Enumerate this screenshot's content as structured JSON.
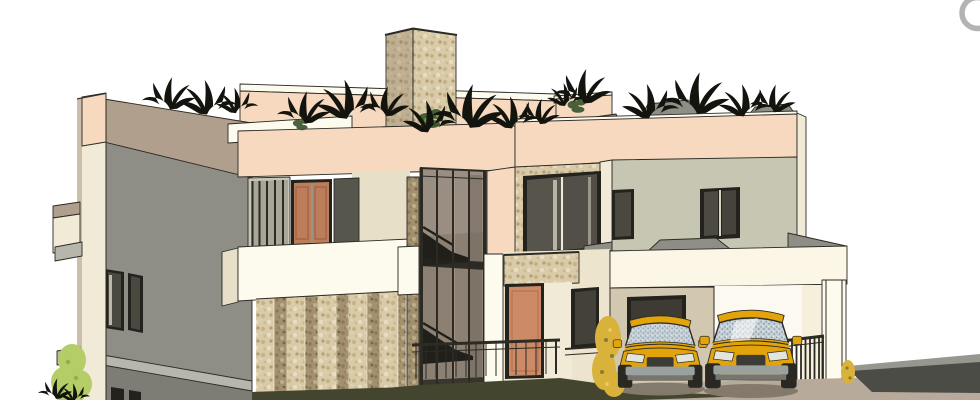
{
  "meta": {
    "type": "3d-architectural-viewport",
    "width": 980,
    "height": 400
  },
  "scene": {
    "parts": {
      "viewport": "3D exterior view of modern two-storey villa",
      "backParapet": "rear roof parapet",
      "tower": "stone chimney tower",
      "leftWing": "grey side wing",
      "balcony": "upper balcony with terracotta doors",
      "stoneWall": "striped stone feature wall",
      "stairwell": "double-height glazed stairwell",
      "windowBay": "stone-clad window bay",
      "entry": "entrance porch with terracotta door",
      "rightWing": "right bedroom wing",
      "carport": "carport",
      "cars": "two yellow SUVs",
      "landscaping": "shrubs and planting",
      "roofGarden": "roof garden plants",
      "ground": "driveway and ground",
      "navWheel": "view navigation wheel control"
    }
  },
  "palette": {
    "line": "#2b2a24",
    "white": "#fdfaee",
    "cream": "#f1ead6",
    "creamDark": "#e7dfc8",
    "peach": "#f6d9bf",
    "peachCap": "#fbe9d6",
    "mocha": "#b09f8d",
    "grayWall": "#8f8e86",
    "grayWallDark": "#7d7c75",
    "grayLight": "#b7b6ad",
    "sage": "#c7c6b2",
    "panelDark": "#57564c",
    "frameDark": "#23221d",
    "glassDark": "#4a483f",
    "glassCurtain": "#8c8073",
    "stoneBase": "#d9cba8",
    "stoneDarkBase": "#a3906f",
    "door": "#cd8a66",
    "doorBalcony": "#bd7c5a",
    "taupeWall": "#d2c8b2",
    "carYellow": "#e2a40a",
    "carGlass": "#c8d1d7",
    "bumper": "#9ba19f",
    "tire": "#2a2822",
    "ground": "#b8aa9a",
    "groundShadow": "#43452f",
    "rampDark": "#4c4c47",
    "rampLight": "#98978f",
    "plant": "#14140f",
    "greenShrub": "#b5cd67",
    "greenDark": "#37522a",
    "yellowShrub": "#d9b23c",
    "navRing": "#b3b3b3"
  }
}
